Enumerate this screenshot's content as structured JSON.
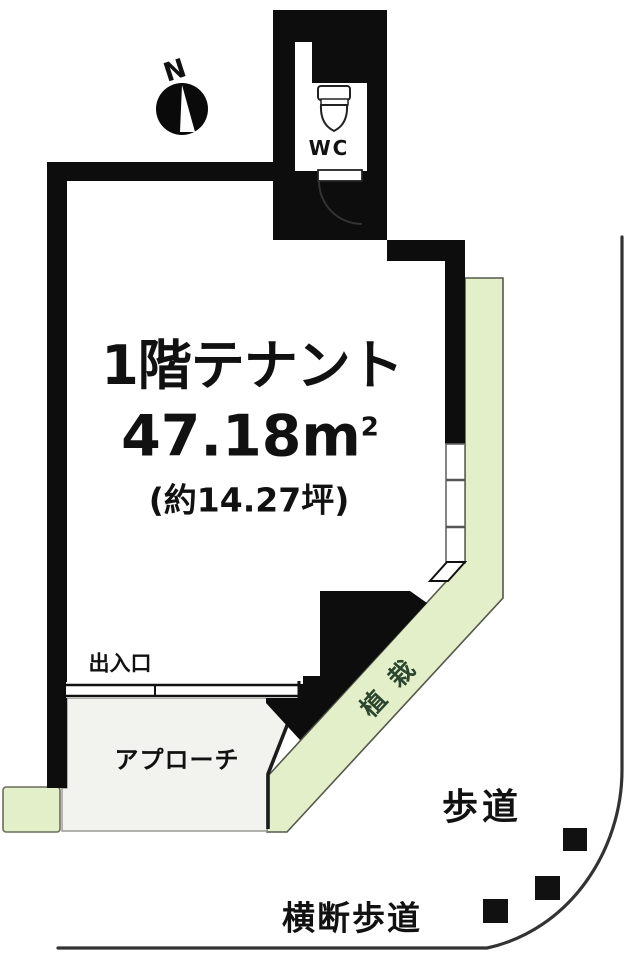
{
  "plan": {
    "compass": {
      "north": "N"
    },
    "unit_label": "1階テナント",
    "area_m2": "47.18m",
    "area_sup": "2",
    "area_tsubo": "(約14.27坪)",
    "area_value_m2": 47.18,
    "area_value_tsubo": 14.27,
    "floor": 1,
    "rooms": {
      "wc": "WC"
    },
    "labels": {
      "entrance": "出入口",
      "approach": "アプローチ",
      "planting": "植栽",
      "sidewalk": "歩道",
      "crosswalk": "横断歩道"
    },
    "colors": {
      "wall": "#0d0d0d",
      "planting_fill": "#e3efc9",
      "planting_border": "#55584a",
      "planting_text": "#2c452e",
      "approach_fill": "#f2f2ef",
      "road_line": "#333333",
      "crosswalk_marker": "#111111"
    }
  }
}
